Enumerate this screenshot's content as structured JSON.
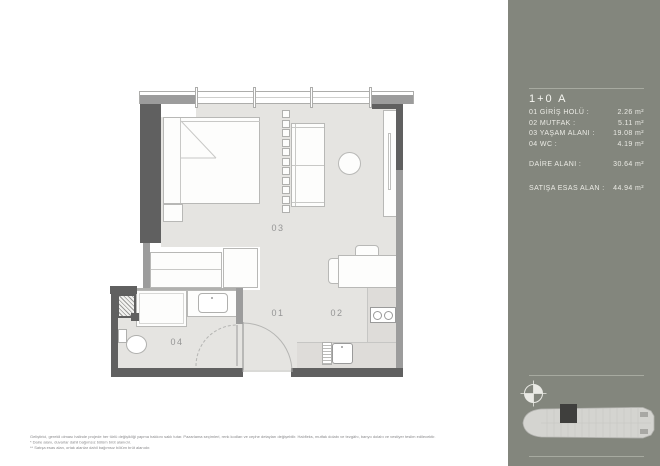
{
  "sidebar": {
    "title": "1+0 A",
    "rooms": [
      {
        "label": "01 GİRİŞ HOLÜ :",
        "value": "2.26 m²"
      },
      {
        "label": "02 MUTFAK :",
        "value": "5.11 m²"
      },
      {
        "label": "03 YAŞAM ALANI :",
        "value": "19.08 m²"
      },
      {
        "label": "04 WC :",
        "value": "4.19 m²"
      }
    ],
    "totals": [
      {
        "label": "DAİRE ALANI :",
        "value": "30.64 m²"
      },
      {
        "label": "SATIŞA ESAS ALAN :",
        "value": "44.94 m²"
      }
    ],
    "icons": [
      "compass-icon",
      "building-key-plan"
    ],
    "colors": {
      "background": "#83867d",
      "divider": "#a7aaa0",
      "text": "#ebebe5"
    }
  },
  "plan": {
    "room_labels": [
      {
        "text": "01"
      },
      {
        "text": "02"
      },
      {
        "text": "03"
      },
      {
        "text": "04"
      }
    ],
    "colors": {
      "floor": "#e5e4e1",
      "wall_exterior": "#606060",
      "wall_interior": "#9c9c9c",
      "counter": "#dedcd9"
    }
  },
  "footnotes": [
    "Geliştirici, gerekli olması halinde projede her türlü değişikliği yapma hakkını saklı tutar. Pazarlama seçimleri, renk kodları ve cephe detayları değişebilir. Halıfleks, mutfak dolabı ve tezgâhı, banyo dolabı ve vestiyer teslim edilecektir.",
    "* Daire alanı, duvarlar dahil bağımsız bölüm brüt alanıdır.",
    "** Satışa esas alan, ortak alanlar dahil bağımsız bölüm brüt alanıdır."
  ]
}
